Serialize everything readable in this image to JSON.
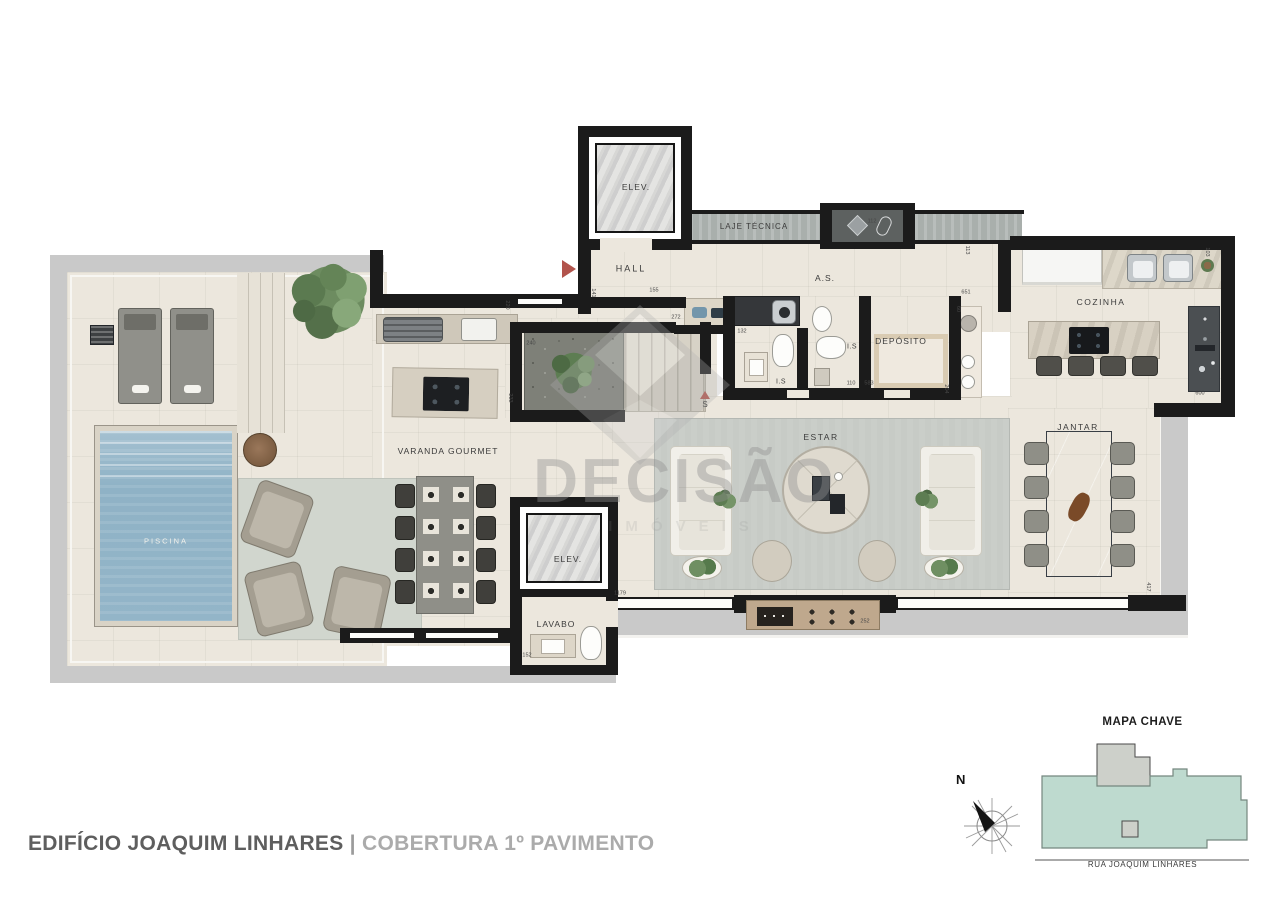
{
  "watermark": {
    "brand": "DECISÃO",
    "subtitle": "IMÓVEIS"
  },
  "footer": {
    "building": "EDIFÍCIO JOAQUIM LINHARES",
    "separator": "|",
    "floor_label": "COBERTURA 1º PAVIMENTO"
  },
  "key_map": {
    "title": "MAPA CHAVE",
    "street": "RUA JOAQUIM LINHARES",
    "compass_north_label": "N"
  },
  "markers": {
    "stairs": "S"
  },
  "room_labels": [
    {
      "id": "elev-top",
      "label": "ELEV.",
      "x": 636,
      "y": 187,
      "size": 8.5,
      "ls": 1
    },
    {
      "id": "laje-tecnica",
      "label": "LAJE TÉCNICA",
      "x": 754,
      "y": 227,
      "size": 8,
      "ls": 1
    },
    {
      "id": "hall",
      "label": "HALL",
      "x": 631,
      "y": 269,
      "size": 9,
      "ls": 2
    },
    {
      "id": "as",
      "label": "A.S.",
      "x": 825,
      "y": 278,
      "size": 8.5,
      "ls": 1
    },
    {
      "id": "is-1",
      "label": "I.S",
      "x": 781,
      "y": 382,
      "size": 7,
      "ls": 0.5
    },
    {
      "id": "is-2",
      "label": "I.S",
      "x": 852,
      "y": 347,
      "size": 7,
      "ls": 0.5
    },
    {
      "id": "deposito",
      "label": "DEPÓSITO",
      "x": 901,
      "y": 341,
      "size": 8.5,
      "ls": 1
    },
    {
      "id": "cozinha",
      "label": "COZINHA",
      "x": 1101,
      "y": 302,
      "size": 8.5,
      "ls": 1.5
    },
    {
      "id": "varanda-gourmet",
      "label": "VARANDA GOURMET",
      "x": 448,
      "y": 451,
      "size": 8.5,
      "ls": 1
    },
    {
      "id": "piscina",
      "label": "PISCINA",
      "x": 166,
      "y": 541,
      "size": 7.5,
      "ls": 2,
      "color": "#f2f1ec"
    },
    {
      "id": "estar",
      "label": "ESTAR",
      "x": 821,
      "y": 437,
      "size": 8.5,
      "ls": 1.5
    },
    {
      "id": "jantar",
      "label": "JANTAR",
      "x": 1078,
      "y": 427,
      "size": 8.5,
      "ls": 1.5
    },
    {
      "id": "elev-bottom",
      "label": "ELEV.",
      "x": 568,
      "y": 559,
      "size": 8.5,
      "ls": 1
    },
    {
      "id": "lavabo",
      "label": "LAVABO",
      "x": 556,
      "y": 624,
      "size": 8.5,
      "ls": 1
    },
    {
      "id": "stairs-s",
      "label": "S",
      "x": 705,
      "y": 405,
      "size": 8,
      "ls": 0
    }
  ],
  "dimension_labels": [
    {
      "text": "272",
      "x": 676,
      "y": 318,
      "rot": 0
    },
    {
      "text": "141",
      "x": 592,
      "y": 293,
      "rot": 90
    },
    {
      "text": "155",
      "x": 654,
      "y": 291,
      "rot": 0
    },
    {
      "text": "112",
      "x": 872,
      "y": 222,
      "rot": 0
    },
    {
      "text": "113",
      "x": 966,
      "y": 250,
      "rot": 90
    },
    {
      "text": "103",
      "x": 1206,
      "y": 252,
      "rot": 90
    },
    {
      "text": "651",
      "x": 966,
      "y": 293,
      "rot": 0
    },
    {
      "text": "60",
      "x": 957,
      "y": 309,
      "rot": 90
    },
    {
      "text": "600",
      "x": 1200,
      "y": 394,
      "rot": 0
    },
    {
      "text": "132",
      "x": 742,
      "y": 332,
      "rot": 0
    },
    {
      "text": "110",
      "x": 851,
      "y": 384,
      "rot": 0
    },
    {
      "text": "583",
      "x": 869,
      "y": 384,
      "rot": 0
    },
    {
      "text": "204",
      "x": 945,
      "y": 389,
      "rot": 90
    },
    {
      "text": "417",
      "x": 1147,
      "y": 587,
      "rot": 90
    },
    {
      "text": "1179",
      "x": 620,
      "y": 594,
      "rot": 0
    },
    {
      "text": "152",
      "x": 527,
      "y": 656,
      "rot": 0
    },
    {
      "text": "252",
      "x": 865,
      "y": 622,
      "rot": 0
    },
    {
      "text": "240",
      "x": 531,
      "y": 344,
      "rot": 0
    },
    {
      "text": "233",
      "x": 509,
      "y": 398,
      "rot": 90
    },
    {
      "text": "220",
      "x": 506,
      "y": 305,
      "rot": 90
    }
  ],
  "colors": {
    "wall": "#1b1b1b",
    "slab": "#c9c9c9",
    "floor": "#ece7dd",
    "pool_water": "#93b5c8",
    "rug": "#c7cbc6",
    "keymap_fill": "#bedacf",
    "accent_red": "#b2544c",
    "title_dark": "#5e5e5e",
    "title_light": "#ababab"
  }
}
